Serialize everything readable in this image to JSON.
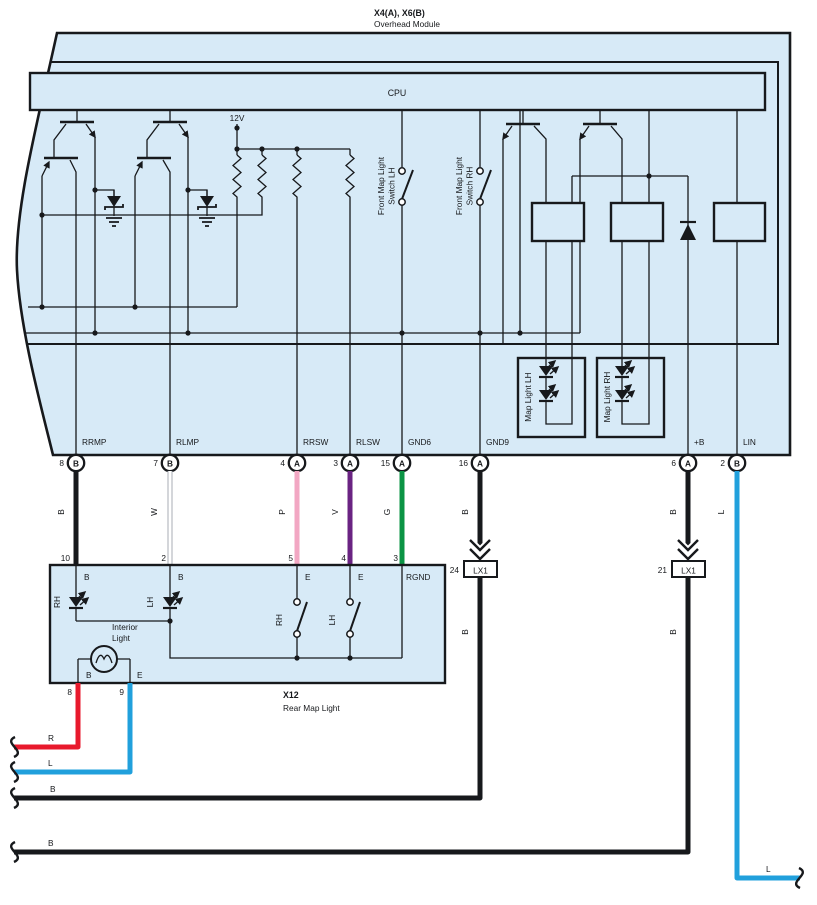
{
  "diagram": {
    "title1": "X4(A), X6(B)",
    "title2": "Overhead Module",
    "cpu": "CPU",
    "v12": "12V",
    "front_switch_lh1": "Front Map Light",
    "front_switch_lh2": "Switch LH",
    "front_switch_rh1": "Front Map Light",
    "front_switch_rh2": "Switch RH",
    "map_light_lh": "Map Light LH",
    "map_light_rh": "Map Light RH",
    "pins": [
      {
        "name": "RRMP",
        "num": "8",
        "conn": "B",
        "wire": "B"
      },
      {
        "name": "RLMP",
        "num": "7",
        "conn": "B",
        "wire": "W"
      },
      {
        "name": "RRSW",
        "num": "4",
        "conn": "A",
        "wire": "P"
      },
      {
        "name": "RLSW",
        "num": "3",
        "conn": "A",
        "wire": "V"
      },
      {
        "name": "GND6",
        "num": "15",
        "conn": "A",
        "wire": "G"
      },
      {
        "name": "GND9",
        "num": "16",
        "conn": "A",
        "wire": "B"
      },
      {
        "name": "+B",
        "num": "6",
        "conn": "A",
        "wire": "B"
      },
      {
        "name": "LIN",
        "num": "2",
        "conn": "B",
        "wire": "L"
      }
    ],
    "lx1a": {
      "num": "24",
      "label": "LX1",
      "wire_below": "B"
    },
    "lx1b": {
      "num": "21",
      "label": "LX1",
      "wire_below": "B"
    },
    "x12": {
      "id": "X12",
      "name": "Rear Map Light",
      "top_pins": [
        {
          "num": "10",
          "label": "B"
        },
        {
          "num": "2",
          "label": "B"
        },
        {
          "num": "5",
          "label": "E"
        },
        {
          "num": "4",
          "label": "E"
        },
        {
          "num": "3",
          "label": "RGND"
        }
      ],
      "bottom_pins": [
        {
          "num": "8",
          "label": "B"
        },
        {
          "num": "9",
          "label": "E"
        }
      ],
      "led_rh": "RH",
      "led_lh": "LH",
      "sw_rh": "RH",
      "sw_lh": "LH",
      "interior1": "Interior",
      "interior2": "Light"
    },
    "bottom_wires": {
      "r": "R",
      "l": "L",
      "b1": "B",
      "b2": "B",
      "lin": "L"
    },
    "colors": {
      "module_fill": "#d7eaf7",
      "line": "#17191c",
      "black_wire": "#17191c",
      "white_wire": "#ffffff",
      "pink": "#f2a7c3",
      "violet": "#6a2382",
      "green": "#0b9444",
      "light_blue": "#21a0dc",
      "red": "#e8192c"
    }
  }
}
